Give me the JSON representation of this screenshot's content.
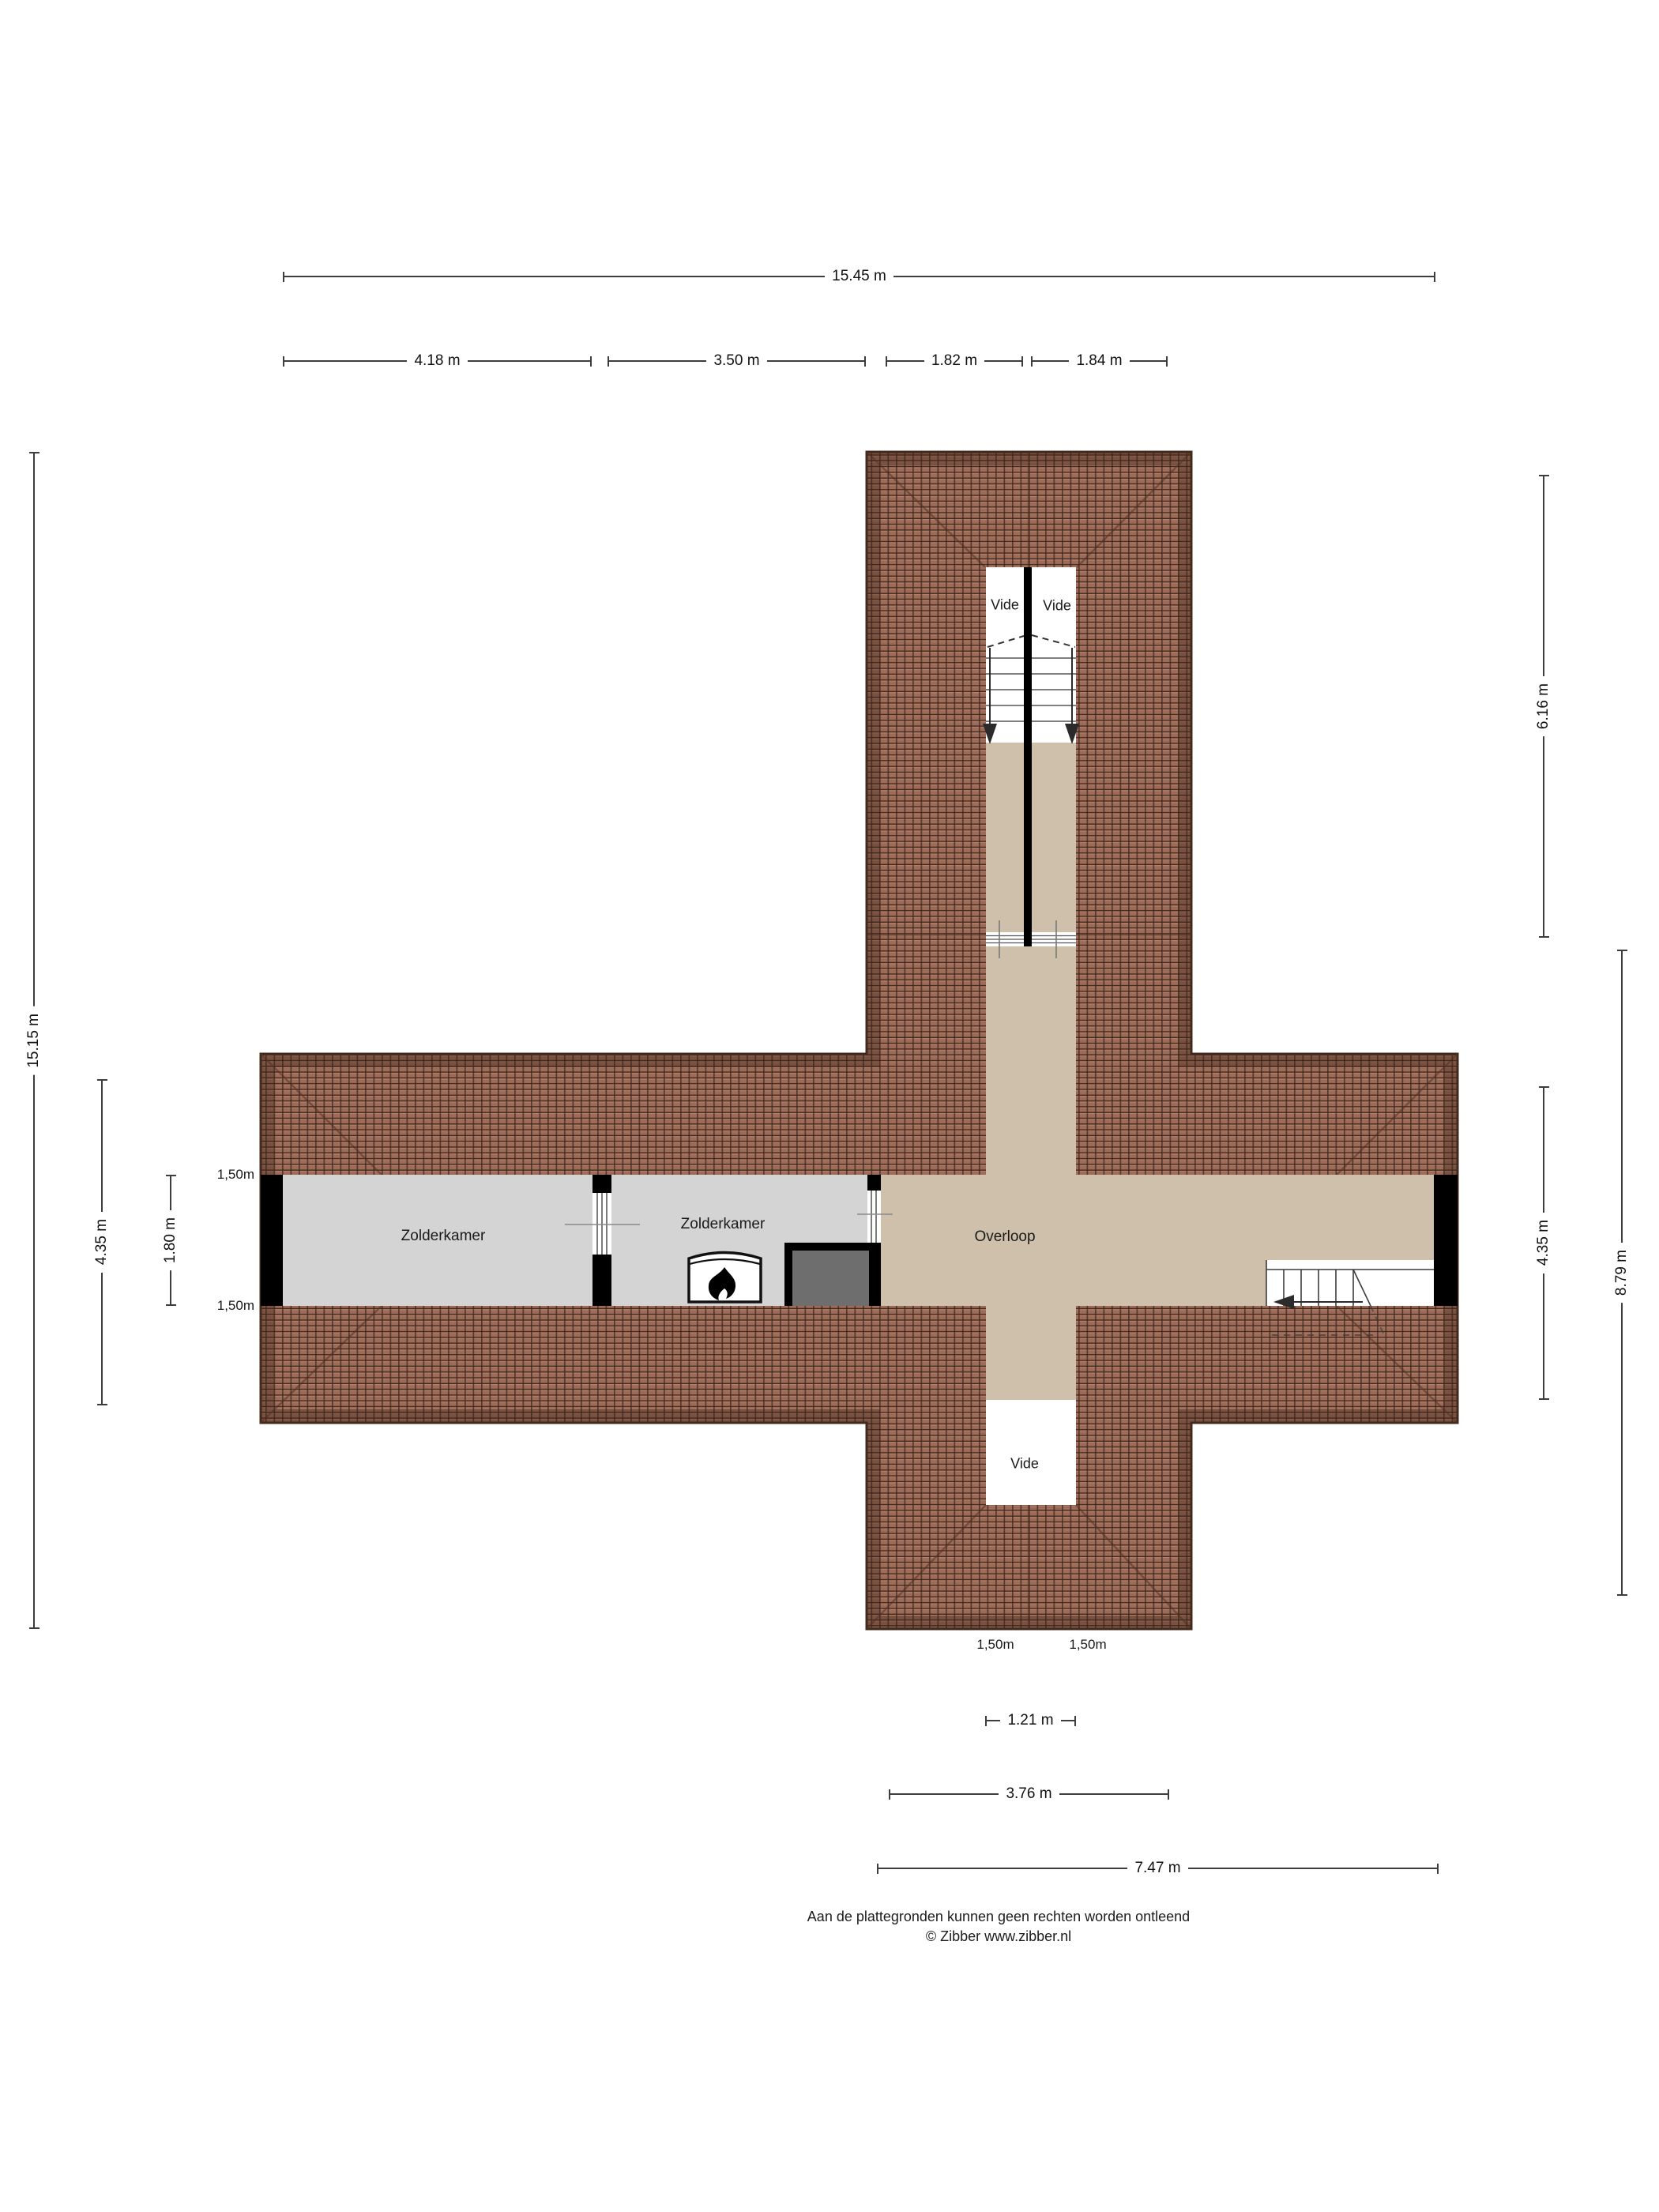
{
  "plan": {
    "rooms": {
      "zolderkamer_left": "Zolderkamer",
      "zolderkamer_right": "Zolderkamer",
      "overloop": "Overloop",
      "vide_top_left": "Vide",
      "vide_top_right": "Vide",
      "vide_bottom": "Vide"
    },
    "knee_wall_labels": {
      "left_top": "1,50m",
      "left_bottom": "1,50m",
      "bottom_left": "1,50m",
      "bottom_right": "1,50m"
    }
  },
  "dimensions": {
    "top_total": "15.45 m",
    "top_segments": [
      "4.18 m",
      "3.50 m",
      "1.82 m",
      "1.84 m"
    ],
    "left": {
      "total": "15.15 m",
      "wing": "4.35 m",
      "room": "1.80 m"
    },
    "right": {
      "vide": "6.16 m",
      "wing": "4.35 m",
      "lower": "8.79 m"
    },
    "bottom": {
      "vide": "1.21 m",
      "inner": "3.76 m",
      "wing": "7.47 m"
    }
  },
  "footer": {
    "line1": "Aan de plattegronden kunnen geen rechten worden ontleend",
    "line2": "© Zibber www.zibber.nl"
  },
  "colors": {
    "roof_tile": "#9d6b58",
    "roof_joint": "#3a241b",
    "roof_highlight": "#b5836c",
    "roof_eaves": "#42291d",
    "floor_landing": "#cec0ab",
    "floor_room": "#d4d4d4",
    "wall": "#000000",
    "block": "#6f6e6e"
  }
}
